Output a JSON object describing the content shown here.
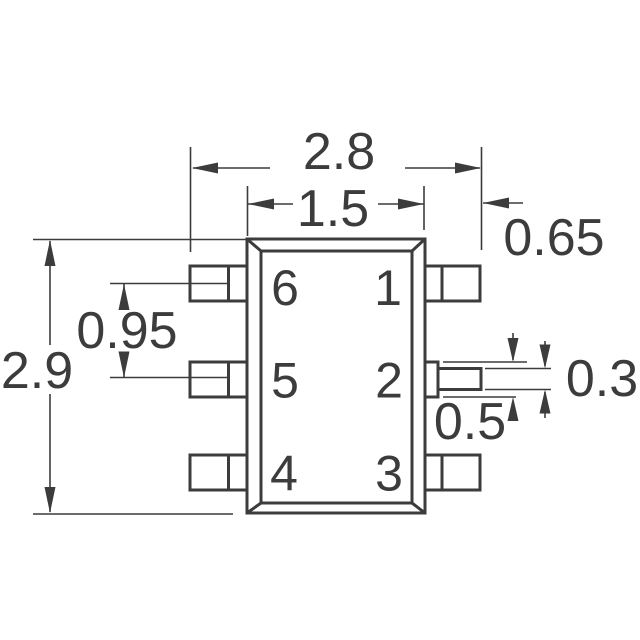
{
  "diagram": {
    "kind": "component-package-outline-drawing",
    "background_color": "#ffffff",
    "line_color": "#3c3c3c",
    "dimensions": {
      "overall_width": "2.8",
      "body_width": "1.5",
      "body_edge_to_lead_tip": "0.65",
      "overall_height": "2.9",
      "lead_pitch": "0.95",
      "lead_width": "0.5",
      "lead_thickness": "0.3"
    },
    "pins": [
      {
        "number": "1"
      },
      {
        "number": "2"
      },
      {
        "number": "3"
      },
      {
        "number": "4"
      },
      {
        "number": "5"
      },
      {
        "number": "6"
      }
    ]
  }
}
